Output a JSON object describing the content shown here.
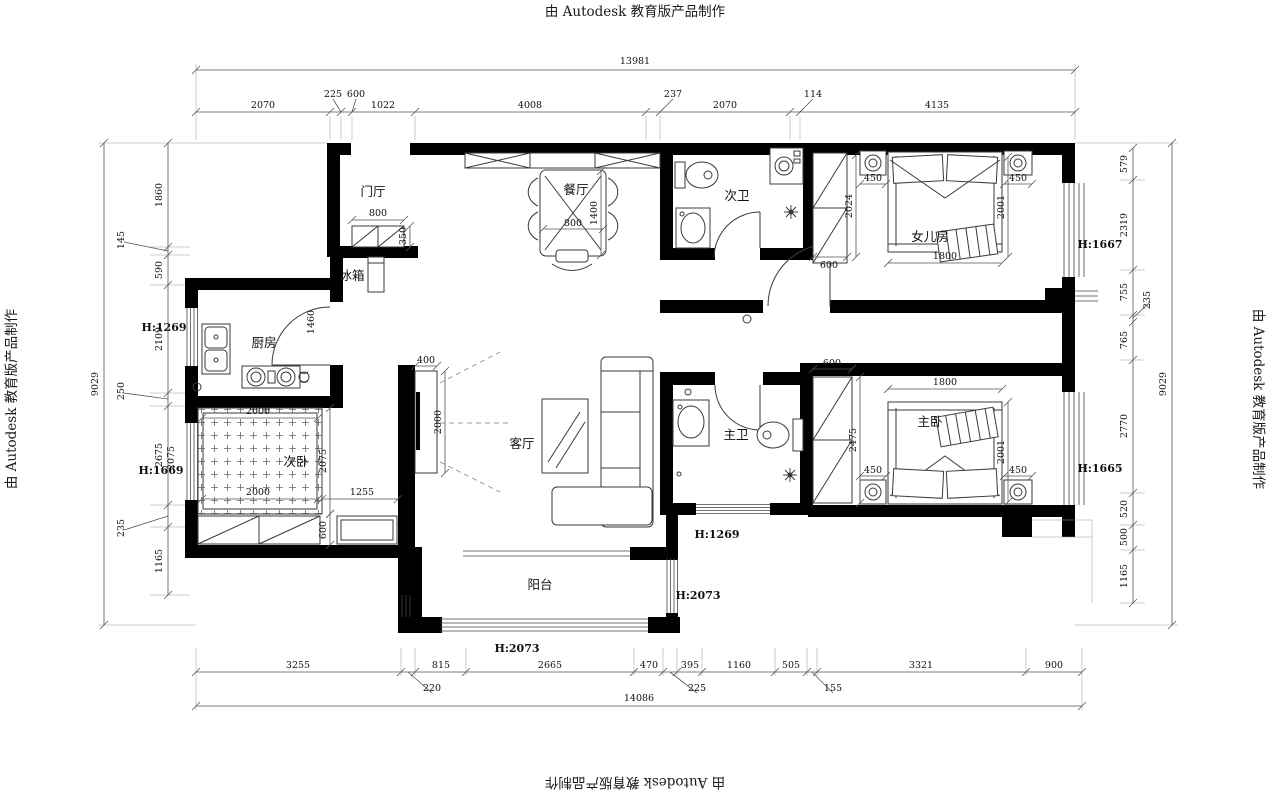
{
  "watermark": "由 Autodesk 教育版产品制作",
  "dim_chains": {
    "top": {
      "overall": "13981",
      "s": [
        "2070",
        "225",
        "600",
        "1022",
        "4008",
        "237",
        "2070",
        "114",
        "4135"
      ]
    },
    "bottom": {
      "overall": "14086",
      "s": [
        "3255",
        "220",
        "815",
        "2665",
        "470",
        "225",
        "395",
        "1160",
        "505",
        "155",
        "3321",
        "900"
      ]
    },
    "left": {
      "overall": "9029",
      "s": [
        "1860",
        "145",
        "590",
        "2109",
        "250",
        "2675",
        "235",
        "1165"
      ]
    },
    "right": {
      "overall": "9029",
      "s": [
        "579",
        "2319",
        "755",
        "235",
        "765",
        "2770",
        "520",
        "500",
        "1165"
      ]
    }
  },
  "rooms": {
    "entry": "门厅",
    "dining": "餐厅",
    "bath2": "次卫",
    "girl_room": "女儿房",
    "fridge": "冰箱",
    "kitchen": "厨房",
    "bed2": "次卧",
    "living": "客厅",
    "bath1": "主卫",
    "bed1": "主卧",
    "balcony": "阳台"
  },
  "heights": {
    "left_h1269": "H:1269",
    "left_h1669": "H:1669",
    "right_h1667": "H:1667",
    "right_h1665": "H:1665",
    "mid_h1269": "H:1269",
    "balcony_h2073": "H:2073",
    "bottom_h2073": "H:2073"
  },
  "inner_dims": {
    "entry_w": "800",
    "entry_d": "350",
    "dining_w": "800",
    "dining_l": "1400",
    "kitchen_door": "1460",
    "girl_ward": "600",
    "girl_ward_h": "2024",
    "girl_ns_l": "450",
    "girl_ns_r": "450",
    "girl_bed_w": "1800",
    "girl_bed_l": "2001",
    "bed2_top": "2000",
    "bed2_bottom": "2000",
    "bed2_h": "2075",
    "bed2_gap": "1255",
    "bed2_cab": "600",
    "left_inner": "2075",
    "tv_w": "400",
    "tv_h": "2000",
    "main_ward": "600",
    "main_ward_h": "2475",
    "main_ns_l": "450",
    "main_ns_r": "450",
    "main_bed_w": "1800",
    "main_bed_l": "2001"
  }
}
